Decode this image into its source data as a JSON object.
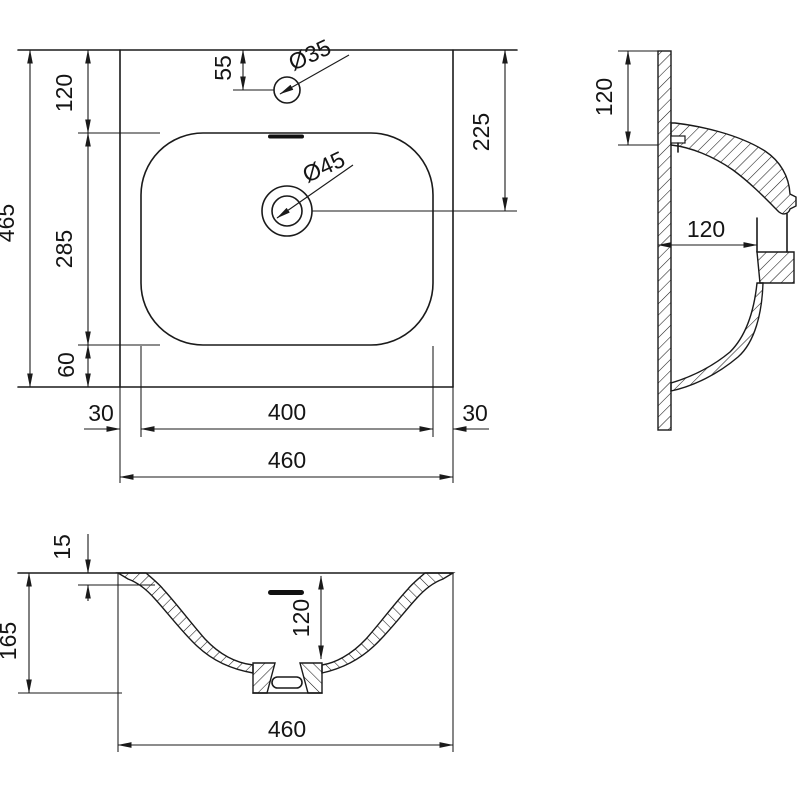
{
  "meta": {
    "background": "#ffffff",
    "line_color": "#1a1a1a",
    "drawing_type": "washbasin technical dimension drawing, three views"
  },
  "views": {
    "plan": {
      "dims": {
        "total_height": "465",
        "top_to_basin": "120",
        "basin_length": "285",
        "basin_to_bottom": "60",
        "faucet_offset": "55",
        "faucet_hole_dia": "Ø35",
        "drain_dia": "Ø45",
        "top_to_drain": "225",
        "margin_left": "30",
        "basin_width": "400",
        "margin_right": "30",
        "total_width": "460"
      }
    },
    "side": {
      "dims": {
        "mount_height": "120",
        "basin_depth": "120"
      }
    },
    "front": {
      "dims": {
        "rim_thickness": "15",
        "total_height": "165",
        "bowl_depth": "120",
        "total_width": "460"
      }
    }
  }
}
